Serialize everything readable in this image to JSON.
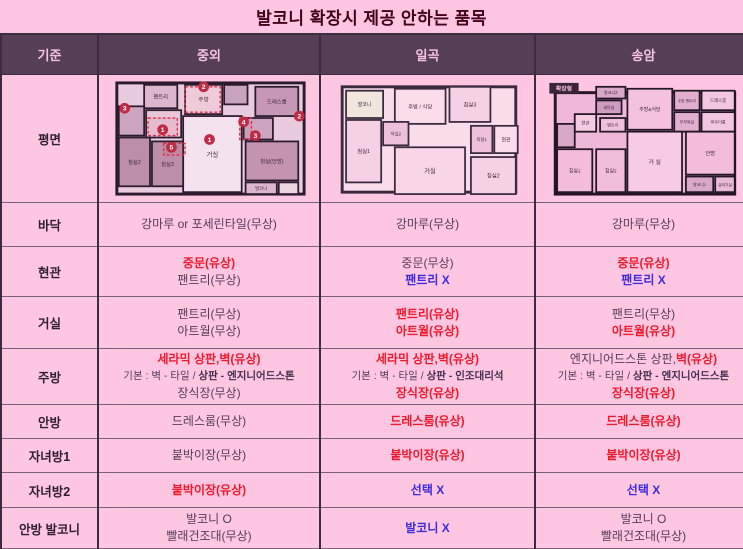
{
  "title": "발코니 확장시 제공 안하는 품목",
  "colors": {
    "page_bg": "#ffc6e2",
    "header_bg": "#543f57",
    "header_text": "#f6c3e2",
    "title_text": "#430018",
    "body_text": "#533c5a",
    "paid_red": "#ee1b2d",
    "excluded_blue": "#3c2bdc",
    "border_dark": "#3b2c3f",
    "border_light": "#77617b"
  },
  "table": {
    "columns": [
      "기준",
      "중외",
      "일곡",
      "송암"
    ],
    "plan_row_label": "평면",
    "rows": [
      {
        "label": "바닥",
        "cells": [
          [
            [
              {
                "t": "강마루 or 포세린타일(무상)",
                "s": "n"
              }
            ]
          ],
          [
            [
              {
                "t": "강마루(무상)",
                "s": "n"
              }
            ]
          ],
          [
            [
              {
                "t": "강마루(무상)",
                "s": "n"
              }
            ]
          ]
        ]
      },
      {
        "label": "현관",
        "cells": [
          [
            [
              {
                "t": "중문(유상)",
                "s": "r"
              }
            ],
            [
              {
                "t": "팬트리(무상)",
                "s": "n"
              }
            ]
          ],
          [
            [
              {
                "t": "중문(무상)",
                "s": "n"
              }
            ],
            [
              {
                "t": "팬트리 X",
                "s": "b"
              }
            ]
          ],
          [
            [
              {
                "t": "중문(유상)",
                "s": "r"
              }
            ],
            [
              {
                "t": "팬트리 X",
                "s": "b"
              }
            ]
          ]
        ]
      },
      {
        "label": "거실",
        "cells": [
          [
            [
              {
                "t": "팬트리(무상)",
                "s": "n"
              }
            ],
            [
              {
                "t": "아트월(무상)",
                "s": "n"
              }
            ]
          ],
          [
            [
              {
                "t": "팬트리(유상)",
                "s": "r"
              }
            ],
            [
              {
                "t": "아트월(유상)",
                "s": "r"
              }
            ]
          ],
          [
            [
              {
                "t": "팬트리(무상)",
                "s": "n"
              }
            ],
            [
              {
                "t": "아트월(유상)",
                "s": "r"
              }
            ]
          ]
        ]
      },
      {
        "label": "주방",
        "cells": [
          [
            [
              {
                "t": "세라믹 상판,벽(유상)",
                "s": "r"
              }
            ],
            [
              {
                "t": "기본 : 벽 - 타일 / ",
                "s": "n"
              },
              {
                "t": "상판 - 엔지니어드스톤",
                "s": "bd"
              }
            ],
            [
              {
                "t": "장식장(무상)",
                "s": "n"
              }
            ]
          ],
          [
            [
              {
                "t": "세라믹 상판,벽(유상)",
                "s": "r"
              }
            ],
            [
              {
                "t": "기본 : 벽 - 타일 / ",
                "s": "n"
              },
              {
                "t": "상판 - 인조대리석",
                "s": "bd"
              }
            ],
            [
              {
                "t": "장식장(유상)",
                "s": "r"
              }
            ]
          ],
          [
            [
              {
                "t": "엔지니어드스톤 상판,",
                "s": "n"
              },
              {
                "t": "벽(유상)",
                "s": "r"
              }
            ],
            [
              {
                "t": "기본 : 벽 - 타일 / ",
                "s": "n"
              },
              {
                "t": "상판 - 엔지니어드스톤",
                "s": "bd"
              }
            ],
            [
              {
                "t": "장식장(유상)",
                "s": "r"
              }
            ]
          ]
        ]
      },
      {
        "label": "안방",
        "cells": [
          [
            [
              {
                "t": "드레스룸(무상)",
                "s": "n"
              }
            ]
          ],
          [
            [
              {
                "t": "드레스룸(유상)",
                "s": "r"
              }
            ]
          ],
          [
            [
              {
                "t": "드레스룸(유상)",
                "s": "r"
              }
            ]
          ]
        ]
      },
      {
        "label": "자녀방1",
        "cells": [
          [
            [
              {
                "t": "붙박이장(무상)",
                "s": "n"
              }
            ]
          ],
          [
            [
              {
                "t": "붙박이장(유상)",
                "s": "r"
              }
            ]
          ],
          [
            [
              {
                "t": "붙박이장(유상)",
                "s": "r"
              }
            ]
          ]
        ]
      },
      {
        "label": "자녀방2",
        "cells": [
          [
            [
              {
                "t": "붙박이장(유상)",
                "s": "r"
              }
            ]
          ],
          [
            [
              {
                "t": "선택 X",
                "s": "b"
              }
            ]
          ],
          [
            [
              {
                "t": "선택 X",
                "s": "b"
              }
            ]
          ]
        ]
      },
      {
        "label": "안방 발코니",
        "cells": [
          [
            [
              {
                "t": "발코니 O",
                "s": "n"
              }
            ],
            [
              {
                "t": "빨래건조대(무상)",
                "s": "n"
              }
            ]
          ],
          [
            [
              {
                "t": "발코니 X",
                "s": "b"
              }
            ]
          ],
          [
            [
              {
                "t": "발코니 O",
                "s": "n"
              }
            ],
            [
              {
                "t": "빨래건조대(무상)",
                "s": "n"
              }
            ]
          ]
        ]
      }
    ]
  },
  "floorplans": [
    {
      "id": "jungoe",
      "vw": 210,
      "vh": 122,
      "dw": 205,
      "dh": 119,
      "wall": "#2c1b2e",
      "bg": {
        "x": 10,
        "y": 4,
        "w": 192,
        "h": 114,
        "fill": "#e8cbdd"
      },
      "rooms": [
        {
          "label": "펜트리",
          "x": 38,
          "y": 6,
          "w": 34,
          "h": 24,
          "fill": "#dcb6cc",
          "fs": 5.5
        },
        {
          "label": "주방",
          "x": 80,
          "y": 6,
          "w": 38,
          "h": 30,
          "fill": "#f0d8e6",
          "fs": 6
        },
        {
          "label": "",
          "x": 120,
          "y": 6,
          "w": 24,
          "h": 20,
          "fill": "#c9a2bd",
          "fs": 5
        },
        {
          "label": "드레스룸",
          "x": 152,
          "y": 8,
          "w": 44,
          "h": 30,
          "fill": "#c697b6",
          "fs": 5.5
        },
        {
          "label": "",
          "x": 12,
          "y": 28,
          "w": 26,
          "h": 30,
          "fill": "#cda5c0",
          "fs": 5
        },
        {
          "label": "",
          "x": 40,
          "y": 32,
          "w": 36,
          "h": 28,
          "fill": "#e6c6d8",
          "fs": 5
        },
        {
          "label": "거실",
          "x": 78,
          "y": 38,
          "w": 60,
          "h": 78,
          "fill": "#f4e3ee",
          "fs": 6.5
        },
        {
          "label": "",
          "x": 140,
          "y": 40,
          "w": 30,
          "h": 22,
          "fill": "#cda5c0",
          "fs": 5
        },
        {
          "label": "침실(안방)",
          "x": 142,
          "y": 64,
          "w": 54,
          "h": 40,
          "fill": "#c493ae",
          "fs": 5.5
        },
        {
          "label": "침실2",
          "x": 12,
          "y": 60,
          "w": 32,
          "h": 50,
          "fill": "#bd8ea9",
          "fs": 5.5
        },
        {
          "label": "침실3",
          "x": 46,
          "y": 64,
          "w": 32,
          "h": 46,
          "fill": "#bd8ea9",
          "fs": 5.5
        },
        {
          "label": "발코니",
          "x": 142,
          "y": 106,
          "w": 32,
          "h": 12,
          "fill": "#dcb6cc",
          "fs": 4.5
        },
        {
          "label": "",
          "x": 176,
          "y": 106,
          "w": 20,
          "h": 12,
          "fill": "#ecd5e3",
          "fs": 4
        }
      ],
      "dashes": [
        {
          "x": 80,
          "y": 8,
          "w": 36,
          "h": 26
        },
        {
          "x": 42,
          "y": 40,
          "w": 30,
          "h": 18
        },
        {
          "x": 58,
          "y": 66,
          "w": 22,
          "h": 12
        },
        {
          "x": 136,
          "y": 40,
          "w": 12,
          "h": 22
        }
      ],
      "circles": [
        {
          "n": "1",
          "x": 105,
          "y": 62
        },
        {
          "n": "1",
          "x": 57,
          "y": 52
        },
        {
          "n": "2",
          "x": 99,
          "y": 8
        },
        {
          "n": "2",
          "x": 197,
          "y": 38
        },
        {
          "n": "3",
          "x": 18,
          "y": 30
        },
        {
          "n": "3",
          "x": 152,
          "y": 58
        },
        {
          "n": "4",
          "x": 140,
          "y": 44
        },
        {
          "n": "5",
          "x": 66,
          "y": 70
        }
      ]
    },
    {
      "id": "ilgok",
      "vw": 200,
      "vh": 122,
      "dw": 196,
      "dh": 119,
      "wall": "#3a2a3e",
      "bg": {
        "x": 12,
        "y": 8,
        "w": 178,
        "h": 108,
        "fill": "#f8dcea"
      },
      "rooms": [
        {
          "label": "발코니",
          "x": 16,
          "y": 12,
          "w": 38,
          "h": 28,
          "fill": "#f0e6dc",
          "fs": 5
        },
        {
          "label": "주방 / 식당",
          "x": 66,
          "y": 10,
          "w": 52,
          "h": 36,
          "fill": "#fadcea",
          "fs": 5.5
        },
        {
          "label": "침실3",
          "x": 122,
          "y": 8,
          "w": 42,
          "h": 36,
          "fill": "#f6d0e3",
          "fs": 5.5
        },
        {
          "label": "욕실2",
          "x": 54,
          "y": 44,
          "w": 26,
          "h": 24,
          "fill": "#eec0da",
          "fs": 4.5
        },
        {
          "label": "침실1",
          "x": 16,
          "y": 42,
          "w": 36,
          "h": 64,
          "fill": "#f6d0e3",
          "fs": 5.5
        },
        {
          "label": "욕실1",
          "x": 144,
          "y": 48,
          "w": 22,
          "h": 28,
          "fill": "#eec0da",
          "fs": 4.5
        },
        {
          "label": "현관",
          "x": 168,
          "y": 48,
          "w": 24,
          "h": 28,
          "fill": "#fadcea",
          "fs": 5
        },
        {
          "label": "거실",
          "x": 66,
          "y": 70,
          "w": 72,
          "h": 48,
          "fill": "#f8d6e7",
          "fs": 6.5
        },
        {
          "label": "침실2",
          "x": 144,
          "y": 80,
          "w": 46,
          "h": 38,
          "fill": "#f6d0e3",
          "fs": 5.5
        }
      ],
      "dashes": [],
      "circles": []
    },
    {
      "id": "songam",
      "vw": 205,
      "vh": 122,
      "dw": 201,
      "dh": 119,
      "wall": "#241626",
      "bg": {
        "x": 12,
        "y": 14,
        "w": 184,
        "h": 104,
        "fill": "#f0b8d8"
      },
      "badge": {
        "label": "확장형",
        "x": 6,
        "y": 4,
        "w": 30,
        "h": 11,
        "fill": "#3a2438",
        "text": "#f8c0de",
        "fs": 6
      },
      "rooms": [
        {
          "label": "발코니2",
          "x": 54,
          "y": 8,
          "w": 30,
          "h": 12,
          "fill": "#d9a8c8",
          "fs": 4.2
        },
        {
          "label": "세탁실",
          "x": 54,
          "y": 22,
          "w": 26,
          "h": 14,
          "fill": "#cf9dc0",
          "fs": 4.2
        },
        {
          "label": "주방&식당",
          "x": 86,
          "y": 10,
          "w": 46,
          "h": 42,
          "fill": "#f4c2de",
          "fs": 5
        },
        {
          "label": "주방 팬트리",
          "x": 134,
          "y": 12,
          "w": 26,
          "h": 20,
          "fill": "#e2aed0",
          "fs": 3.8
        },
        {
          "label": "드레스룸",
          "x": 162,
          "y": 12,
          "w": 34,
          "h": 20,
          "fill": "#f2c6de",
          "fs": 4.5
        },
        {
          "label": "현관",
          "x": 32,
          "y": 36,
          "w": 22,
          "h": 18,
          "fill": "#f4cce2",
          "fs": 4.5
        },
        {
          "label": "팬트리",
          "x": 58,
          "y": 40,
          "w": 26,
          "h": 14,
          "fill": "#efc0da",
          "fs": 4.2
        },
        {
          "label": "부부욕실",
          "x": 134,
          "y": 34,
          "w": 26,
          "h": 20,
          "fill": "#e2aed0",
          "fs": 4
        },
        {
          "label": "파우더룸",
          "x": 162,
          "y": 34,
          "w": 34,
          "h": 20,
          "fill": "#f2c6de",
          "fs": 4.2
        },
        {
          "label": "",
          "x": 14,
          "y": 46,
          "w": 18,
          "h": 24,
          "fill": "#d9a8c8",
          "fs": 4
        },
        {
          "label": "침실1",
          "x": 14,
          "y": 72,
          "w": 36,
          "h": 44,
          "fill": "#f2bcda",
          "fs": 5
        },
        {
          "label": "침실2",
          "x": 54,
          "y": 72,
          "w": 30,
          "h": 44,
          "fill": "#f2bcda",
          "fs": 5
        },
        {
          "label": "거 실",
          "x": 86,
          "y": 54,
          "w": 56,
          "h": 62,
          "fill": "#f6cbe3",
          "fs": 6
        },
        {
          "label": "안방",
          "x": 146,
          "y": 54,
          "w": 50,
          "h": 44,
          "fill": "#f2bcda",
          "fs": 5.5
        },
        {
          "label": "발코니1",
          "x": 146,
          "y": 100,
          "w": 28,
          "h": 16,
          "fill": "#d9a8c8",
          "fs": 4
        },
        {
          "label": "실외기실",
          "x": 176,
          "y": 100,
          "w": 20,
          "h": 16,
          "fill": "#e8b8d4",
          "fs": 3.8
        }
      ],
      "dashes": [],
      "circles": []
    }
  ]
}
